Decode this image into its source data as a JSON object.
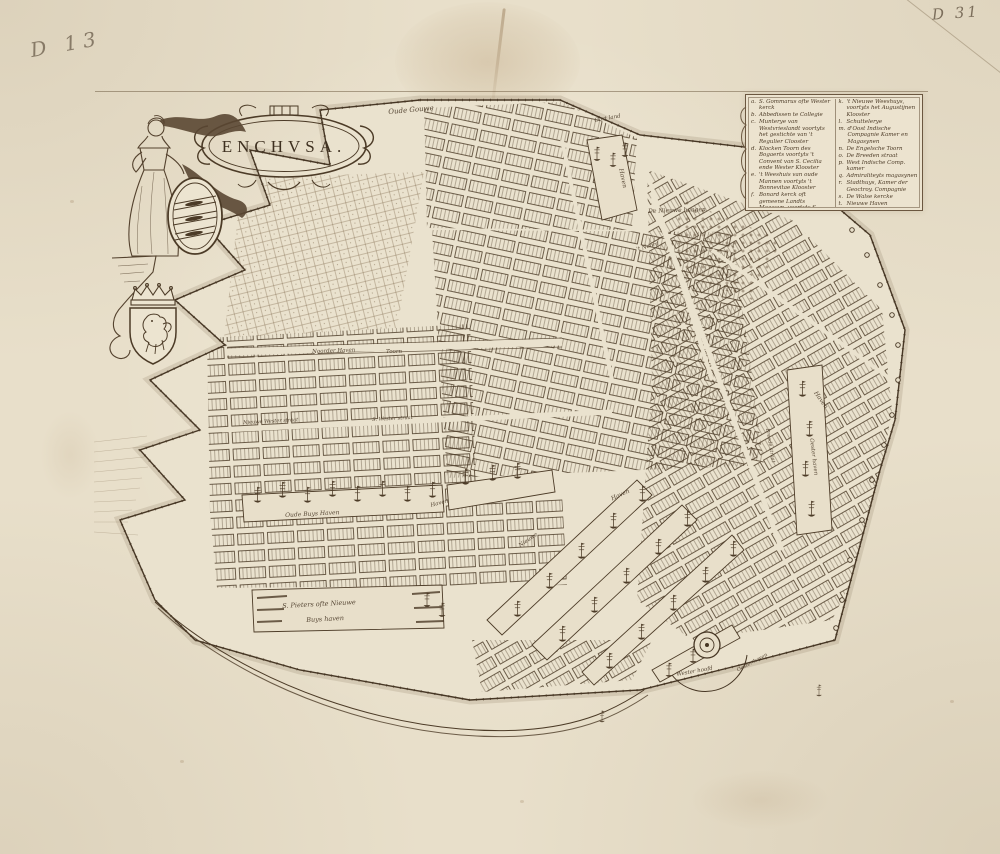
{
  "artwork": {
    "title": "ENCHVSA."
  },
  "annotations": {
    "top_left": "D 13",
    "top_right": "D 31"
  },
  "colors": {
    "paper": "#e8dfca",
    "ink": "#4c3b27",
    "ink_light": "#7a6248"
  },
  "legend": {
    "left": [
      {
        "k": "a.",
        "t": "S. Gommarus ofte Wester kerck"
      },
      {
        "k": "b.",
        "t": "Abbedissen te Collegie"
      },
      {
        "k": "c.",
        "t": "Munterye van Westvrieslandt voortyts het gestichte van 't Regulier Clooster"
      },
      {
        "k": "d.",
        "t": "Klocken Toorn des Bogaerts voortyts 't Convent van S. Cecilia ende Wester Klooster"
      },
      {
        "k": "e.",
        "t": "'t Weeshuis van oude Mannen voortyts 't Bonnevitae Klooster"
      },
      {
        "k": "f.",
        "t": "Bonard kerck oft gemeene Landts Magasyn, voortyts S. Catharyn Cap."
      },
      {
        "k": "g.",
        "t": "'t Oude Weeshuys, voortyts 't Convent S. Ursula"
      },
      {
        "k": "h.",
        "t": "S. Pancratius ofte Zuyder kerck"
      },
      {
        "k": "i.",
        "t": "De Bonnicke Kerck"
      }
    ],
    "right": [
      {
        "k": "k.",
        "t": "'t Nieuwe Weeshuys, voortyts het Augustijnen Klooster"
      },
      {
        "k": "l.",
        "t": "Schuttelerye"
      },
      {
        "k": "m.",
        "t": "d'Oost Indische Compagnie Kamer en Magasynen"
      },
      {
        "k": "n.",
        "t": "De Engelsche Toorn"
      },
      {
        "k": "o.",
        "t": "De Breeden straat"
      },
      {
        "k": "p.",
        "t": "West Indische Comp. kamer"
      },
      {
        "k": "q.",
        "t": "Admiraliteyts magasynen"
      },
      {
        "k": "r.",
        "t": "Stadthuys, Kamer der Geoctroy. Compagnie"
      },
      {
        "k": "s.",
        "t": "De Walse kercke"
      },
      {
        "k": "t.",
        "t": "Nieuwe Haven"
      },
      {
        "k": "u.",
        "t": "De oude Wester straat"
      },
      {
        "k": "x.",
        "t": "Ephemelis spuy"
      }
    ]
  },
  "map": {
    "labels": [
      {
        "text": "Oude Gouwe"
      },
      {
        "text": "Oort land"
      },
      {
        "text": "De Nieuwe haagen"
      },
      {
        "text": "'t Noord"
      },
      {
        "text": "Haven"
      },
      {
        "text": "Noorder Haven"
      },
      {
        "text": "Toorn"
      },
      {
        "text": "Nieuwe Wester straat"
      },
      {
        "text": "S. Wester straat"
      },
      {
        "text": "Oude Buys Haven"
      },
      {
        "text": "Haven"
      },
      {
        "text": "Haven"
      },
      {
        "text": "Nieuwe"
      },
      {
        "text": "S. Pieters ofte Nieuwe"
      },
      {
        "text": "Buys haven"
      },
      {
        "text": "Breede straat"
      },
      {
        "text": "Oester haven"
      },
      {
        "text": "Haven"
      },
      {
        "text": "Wester hoofd"
      },
      {
        "text": "Oester haven"
      }
    ]
  }
}
